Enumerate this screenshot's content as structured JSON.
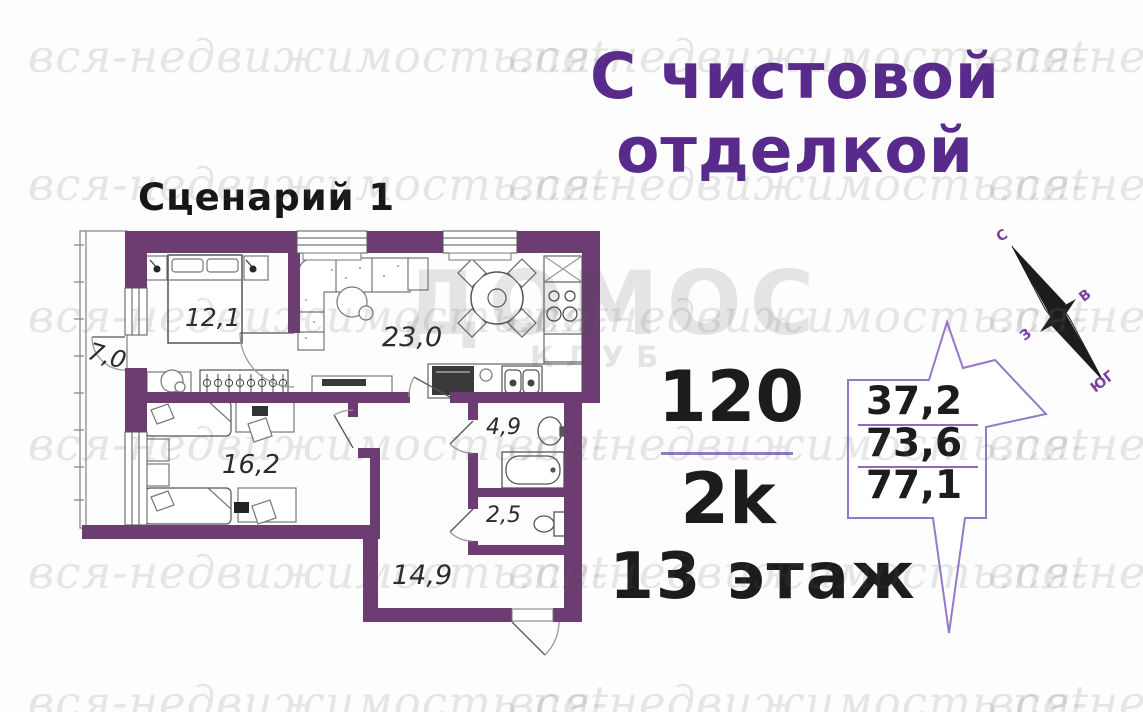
{
  "watermark": {
    "text": "вся-недвижимость.net",
    "brand": "ДОМОС",
    "brand_sub": "КЛУБ"
  },
  "header": {
    "finish_line1": "С чистовой",
    "finish_line2": "отделкой"
  },
  "plan": {
    "scenario": "Сценарий 1",
    "rooms": [
      {
        "id": "balcony",
        "area": "7,0"
      },
      {
        "id": "bedroom-1",
        "area": "12,1"
      },
      {
        "id": "living-kitchen",
        "area": "23,0"
      },
      {
        "id": "bedroom-2",
        "area": "16,2"
      },
      {
        "id": "bathroom",
        "area": "4,9"
      },
      {
        "id": "wc",
        "area": "2,5"
      },
      {
        "id": "hallway",
        "area": "14,9"
      }
    ]
  },
  "info": {
    "apartment_number": "120",
    "layout_type": "2k",
    "floor": "13 этаж",
    "areas": [
      "37,2",
      "73,6",
      "77,1"
    ]
  },
  "compass": {
    "n": "С",
    "e": "В",
    "w": "З",
    "s": "ЮГ"
  },
  "colors": {
    "wall": "#6d3c72",
    "title": "#572a8c",
    "accent_line": "#9678c8"
  }
}
